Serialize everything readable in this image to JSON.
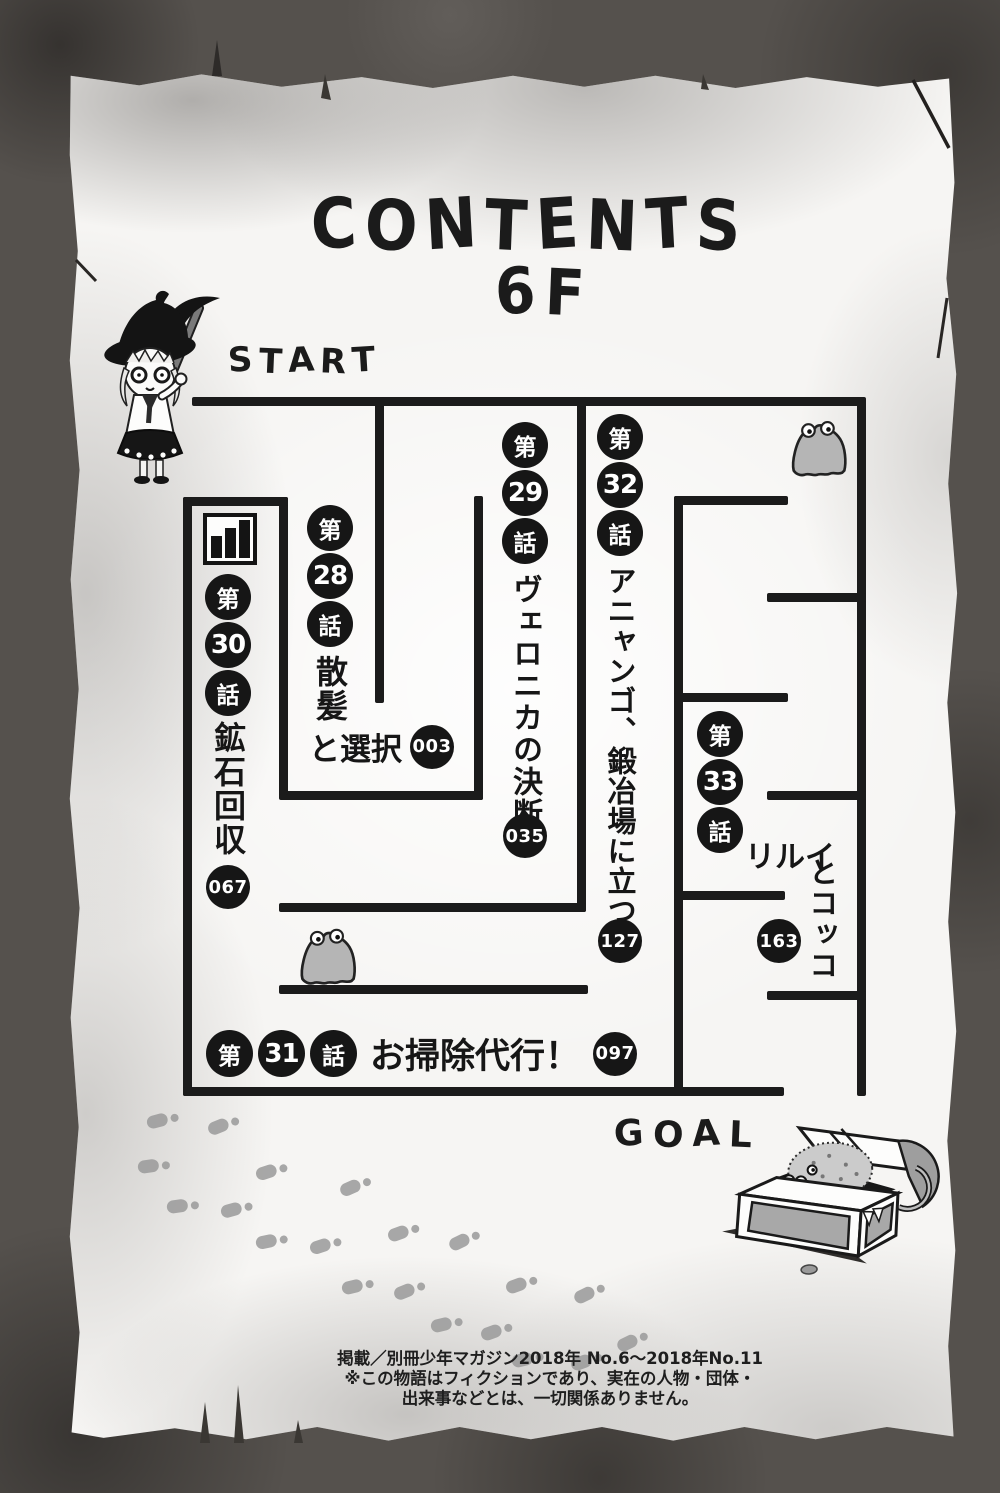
{
  "page": {
    "title_line1": "CONTENTS",
    "title_line2": "6F",
    "start_label": "START",
    "goal_label": "GOAL"
  },
  "chapters": [
    {
      "dai": "第",
      "num": "28",
      "wa": "話",
      "title_full": "散髪と選択",
      "title_vertical": "散髪",
      "title_horizontal": "と選択",
      "page": "003"
    },
    {
      "dai": "第",
      "num": "29",
      "wa": "話",
      "title_full": "ヴェロニカの決断",
      "title_vertical": "ヴェロニカの決断",
      "page": "035"
    },
    {
      "dai": "第",
      "num": "30",
      "wa": "話",
      "title_full": "鉱石回収",
      "title_vertical": "鉱石回収",
      "page": "067"
    },
    {
      "dai": "第",
      "num": "31",
      "wa": "話",
      "title_full": "お掃除代行！",
      "title_horizontal": "お掃除代行！",
      "page": "097"
    },
    {
      "dai": "第",
      "num": "32",
      "wa": "話",
      "title_full": "アニャンゴ、鍛冶場に立つ",
      "title_vertical": "アニャンゴ、鍛冶場に立つ",
      "page": "127"
    },
    {
      "dai": "第",
      "num": "33",
      "wa": "話",
      "title_full": "リルイとコッコ",
      "title_horizontal": "リルイ",
      "title_vertical": "とコッコ",
      "page": "163"
    }
  ],
  "footer": {
    "line1": "掲載／別冊少年マガジン2018年 No.6～2018年No.11",
    "line2": "※この物語はフィクションであり、実在の人物・団体・",
    "line3": "出来事などとは、一切関係ありません。"
  },
  "icons": {
    "witch": "witch-miner-character",
    "slime_top": "slime-monster",
    "slime_bottom": "slime-monster",
    "chest": "treasure-chest-mimic",
    "ore": "ore-bars-icon"
  },
  "colors": {
    "wall": "#1b1b1b",
    "paper": "#f6f5f3",
    "border": "#55514d",
    "badge": "#161616",
    "footprint": "#9a9a9a"
  },
  "maze": {
    "walls": [
      [
        192,
        397,
        673,
        9
      ],
      [
        857,
        397,
        9,
        699
      ],
      [
        375,
        397,
        9,
        306
      ],
      [
        474,
        496,
        9,
        304
      ],
      [
        279,
        791,
        204,
        9
      ],
      [
        279,
        497,
        9,
        298
      ],
      [
        183,
        497,
        105,
        9
      ],
      [
        183,
        497,
        9,
        599
      ],
      [
        183,
        1087,
        601,
        9
      ],
      [
        577,
        397,
        9,
        515
      ],
      [
        279,
        903,
        307,
        9
      ],
      [
        279,
        985,
        309,
        9
      ],
      [
        674,
        496,
        9,
        600
      ],
      [
        674,
        496,
        114,
        9
      ],
      [
        767,
        593,
        99,
        9
      ],
      [
        674,
        693,
        114,
        9
      ],
      [
        767,
        791,
        99,
        9
      ],
      [
        674,
        891,
        111,
        9
      ],
      [
        767,
        991,
        99,
        9
      ]
    ]
  },
  "decorations": {
    "footprints": [
      [
        147,
        1112,
        -15
      ],
      [
        208,
        1117,
        -22
      ],
      [
        138,
        1158,
        -8
      ],
      [
        256,
        1163,
        -18
      ],
      [
        340,
        1178,
        -24
      ],
      [
        167,
        1198,
        -8
      ],
      [
        221,
        1201,
        -16
      ],
      [
        388,
        1224,
        -20
      ],
      [
        449,
        1232,
        -26
      ],
      [
        256,
        1233,
        -12
      ],
      [
        310,
        1237,
        -18
      ],
      [
        342,
        1278,
        -14
      ],
      [
        394,
        1282,
        -22
      ],
      [
        506,
        1276,
        -20
      ],
      [
        574,
        1285,
        -26
      ],
      [
        431,
        1316,
        -14
      ],
      [
        481,
        1323,
        -20
      ],
      [
        617,
        1333,
        -26
      ],
      [
        512,
        1351,
        -14
      ],
      [
        571,
        1353,
        -20
      ]
    ]
  }
}
